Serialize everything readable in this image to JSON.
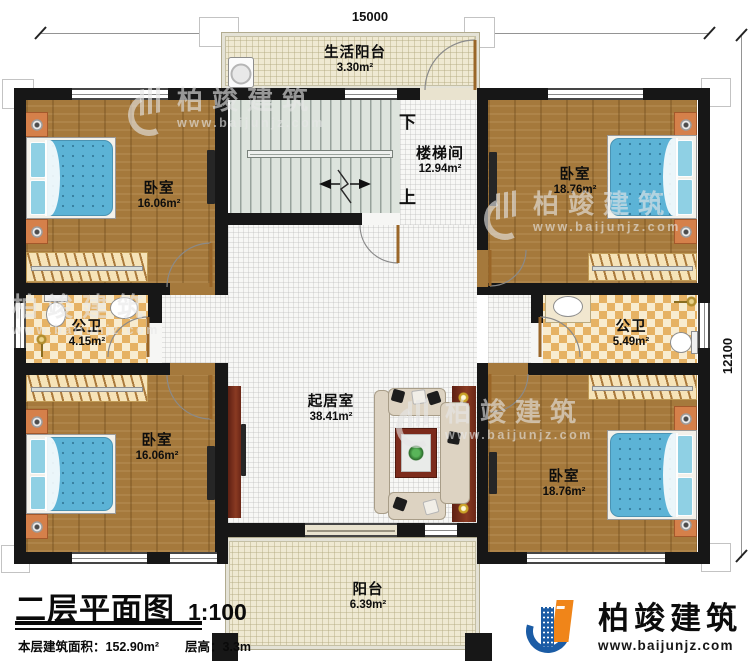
{
  "header": {
    "dim_top": "15000",
    "dim_right": "12100"
  },
  "rooms": {
    "living_balcony": {
      "name": "生活阳台",
      "area": "3.30m²"
    },
    "stairwell": {
      "name": "楼梯间",
      "area": "12.94m²"
    },
    "bedroom_tl": {
      "name": "卧室",
      "area": "16.06m²"
    },
    "bedroom_tr": {
      "name": "卧室",
      "area": "18.76m²"
    },
    "bath_left": {
      "name": "公卫",
      "area": "4.15m²"
    },
    "bath_right": {
      "name": "公卫",
      "area": "5.49m²"
    },
    "living_room": {
      "name": "起居室",
      "area": "38.41m²"
    },
    "bedroom_bl": {
      "name": "卧室",
      "area": "16.06m²"
    },
    "bedroom_br": {
      "name": "卧室",
      "area": "18.76m²"
    },
    "balcony": {
      "name": "阳台",
      "area": "6.39m²"
    }
  },
  "stairs": {
    "down": "下",
    "up": "上"
  },
  "titleblock": {
    "title": "二层平面图",
    "scale": "1:100",
    "area_label": "本层建筑面积：152.90m²",
    "height_label": "层高：3.3m"
  },
  "brand": {
    "name": "柏竣建筑",
    "url": "www.baijunjz.com"
  },
  "watermark": {
    "name": "柏竣建筑",
    "url": "www.baijunjz.com"
  },
  "colors": {
    "wall": "#171717",
    "wood_floor": "#a5793c",
    "bed_blue": "#5cb3d6",
    "tile_orange": "#e6b264",
    "balcony_cream": "#efe9d2",
    "logo_blue": "#1b5ca5",
    "logo_orange": "#f08519"
  }
}
